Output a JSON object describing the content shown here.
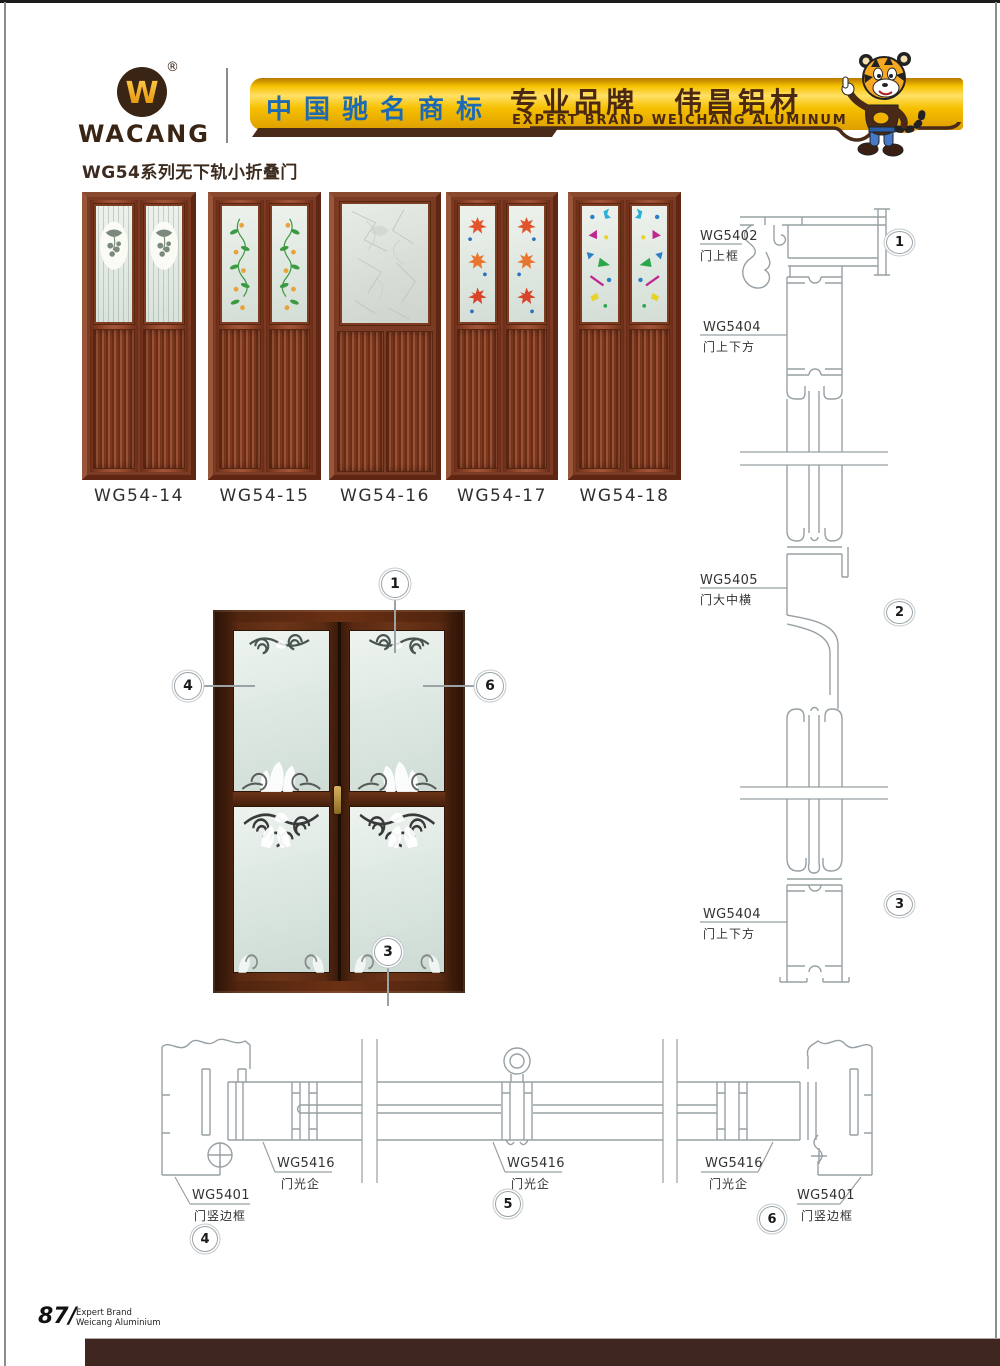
{
  "header": {
    "logo_mark": "W",
    "logo_text": "WACANG",
    "registered_mark": "®",
    "banner_left_cn": "中国驰名商标",
    "banner_right_cn_1": "专业品牌",
    "banner_right_cn_2": "伟昌铝材",
    "banner_right_en": "EXPERT BRAND WEICHANG ALUMINUM"
  },
  "page_title": "WG54系列无下轨小折叠门",
  "products": {
    "items": [
      {
        "label": "WG54-14",
        "glass_pattern": "oval-medallion"
      },
      {
        "label": "WG54-15",
        "glass_pattern": "vine-flowers"
      },
      {
        "label": "WG54-16",
        "glass_pattern": "frost-crackle"
      },
      {
        "label": "WG54-17",
        "glass_pattern": "maple-leaves"
      },
      {
        "label": "WG54-18",
        "glass_pattern": "color-shapes"
      }
    ]
  },
  "diagram": {
    "door_callouts": [
      "1",
      "4",
      "6",
      "3"
    ],
    "vertical_section": {
      "labels": [
        {
          "code": "WG5402",
          "name": "门上框"
        },
        {
          "code": "WG5404",
          "name": "门上下方"
        },
        {
          "code": "WG5405",
          "name": "门大中横"
        },
        {
          "code": "WG5404",
          "name": "门上下方"
        }
      ],
      "callouts": [
        "1",
        "2",
        "3"
      ]
    },
    "horizontal_section": {
      "labels": [
        {
          "code": "WG5401",
          "name": "门竖边框"
        },
        {
          "code": "WG5416",
          "name": "门光企"
        },
        {
          "code": "WG5416",
          "name": "门光企"
        },
        {
          "code": "WG5416",
          "name": "门光企"
        },
        {
          "code": "WG5401",
          "name": "门竖边框"
        }
      ],
      "callouts": [
        "4",
        "5",
        "6"
      ]
    }
  },
  "footer": {
    "page_number": "87",
    "separator": "/",
    "tagline_line1": "Expert Brand",
    "tagline_line2": "Weicang Aluminium"
  },
  "colors": {
    "banner_gold": "#f6c200",
    "banner_blue": "#1d6ab3",
    "brand_brown": "#4a2b1a",
    "wood_red": "#8a4026",
    "drawing_gray": "#9ba3a7",
    "footer_brown": "#3f2620"
  }
}
